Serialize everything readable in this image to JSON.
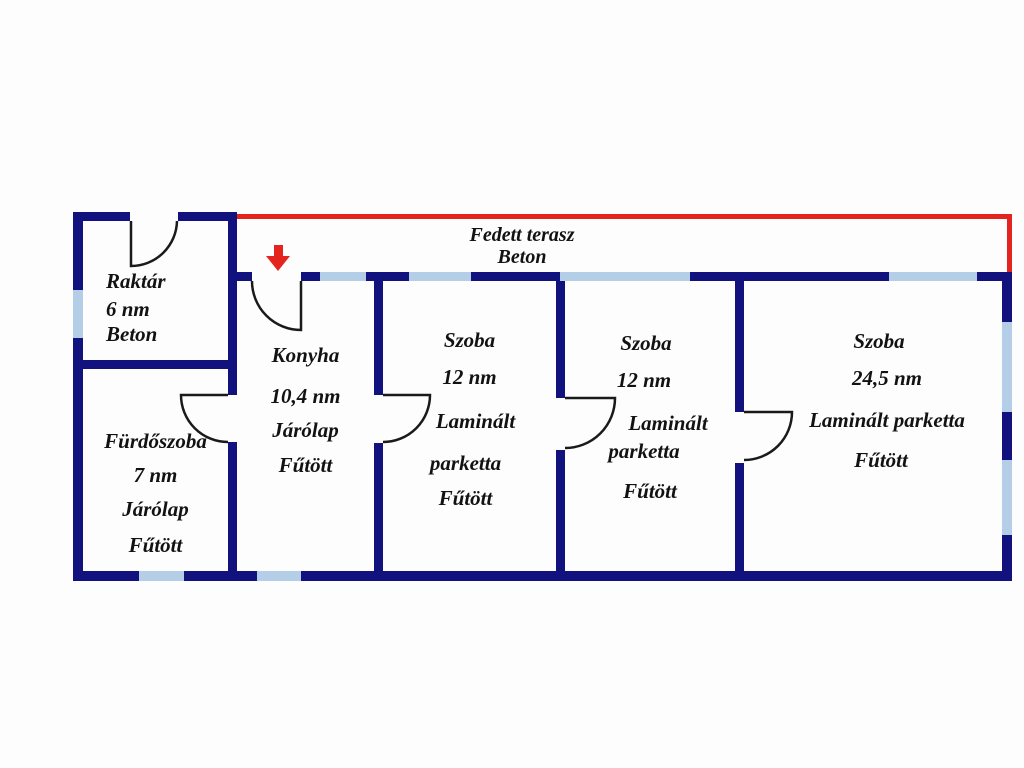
{
  "floorplan": {
    "terrace": {
      "name": "Fedett terasz",
      "floor": "Beton"
    },
    "rooms": [
      {
        "id": "raktar",
        "name": "Raktár",
        "area": "6 nm",
        "floor": "Beton"
      },
      {
        "id": "furdoszoba",
        "name": "Fürdőszoba",
        "area": "7 nm",
        "floor": "Járólap",
        "heating": "Fűtött"
      },
      {
        "id": "konyha",
        "name": "Konyha",
        "area": "10,4 nm",
        "floor": "Járólap",
        "heating": "Fűtött"
      },
      {
        "id": "szoba1",
        "name": "Szoba",
        "area": "12 nm",
        "floor1": "Laminált",
        "floor2": "parketta",
        "heating": "Fűtött"
      },
      {
        "id": "szoba2",
        "name": "Szoba",
        "area": "12 nm",
        "floor1": "Laminált",
        "floor2": "parketta",
        "heating": "Fűtött"
      },
      {
        "id": "szoba3",
        "name": "Szoba",
        "area": "24,5 nm",
        "floor": "Laminált parketta",
        "heating": "Fűtött"
      }
    ],
    "colors": {
      "wall": "#12127E",
      "window": "#B5CEE7",
      "terrace_outline": "#E3241F",
      "entrance_arrow": "#E3241F"
    }
  }
}
